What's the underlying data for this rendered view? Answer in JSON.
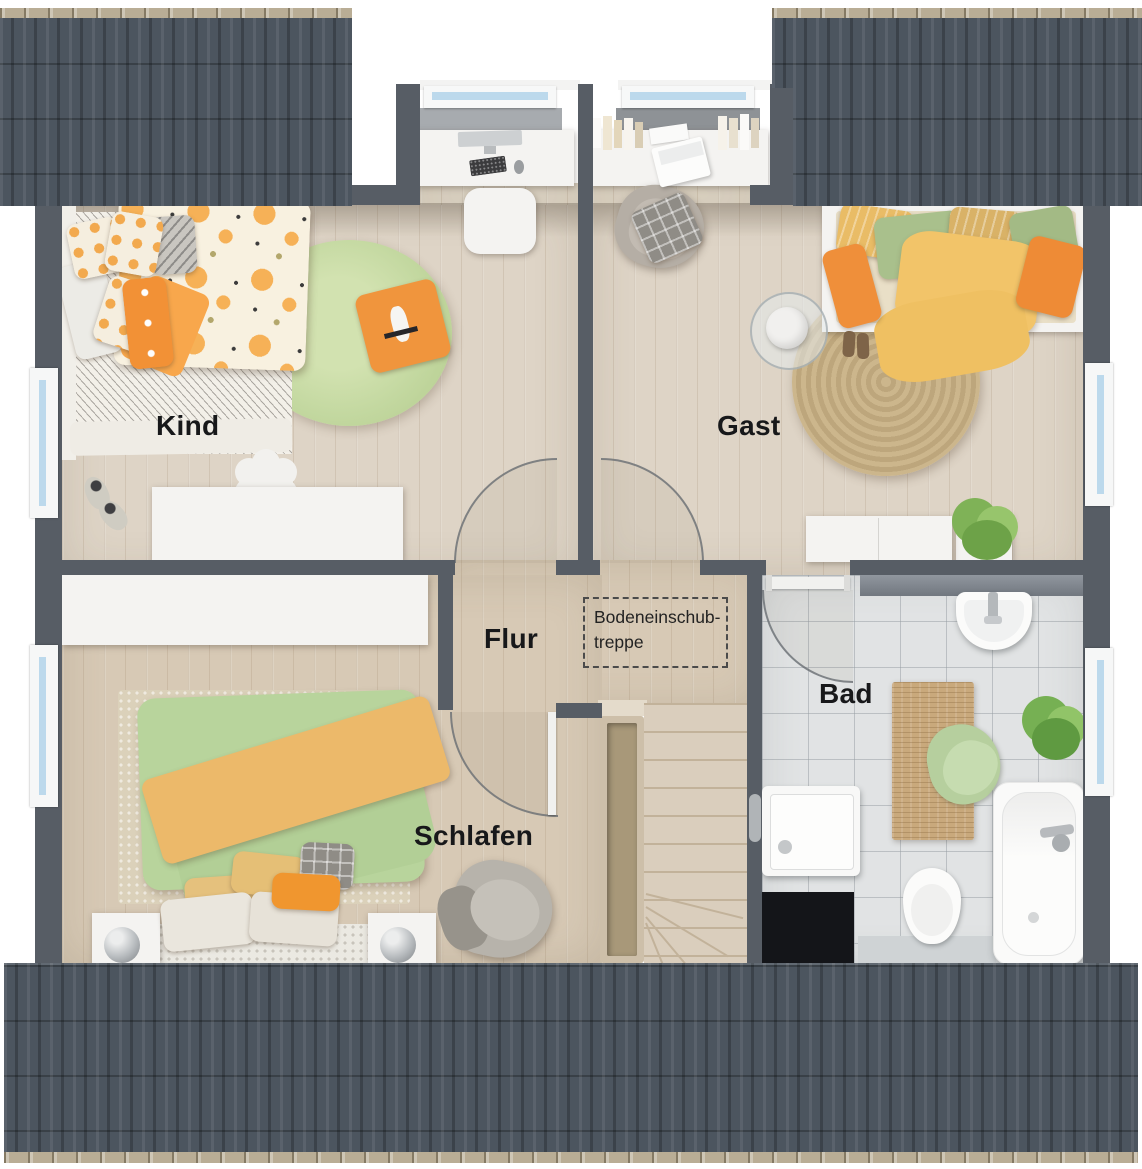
{
  "rooms": {
    "kind": {
      "label": "Kind"
    },
    "gast": {
      "label": "Gast"
    },
    "flur": {
      "label": "Flur"
    },
    "schlafen": {
      "label": "Schlafen"
    },
    "bad": {
      "label": "Bad"
    }
  },
  "annotations": {
    "attic": {
      "line1": "Bodeneinschub-",
      "line2": "treppe"
    }
  },
  "colors": {
    "roof": "#4c555f",
    "wall": "#575d65",
    "wood_floor": "#ded4c6",
    "wood_floor_warm": "#d7c9b5",
    "bath_tile": "#e1e3e4",
    "window_glass": "#bcd9ec",
    "accent_orange": "#ef8f3a",
    "accent_green": "#aec68f",
    "accent_yellow": "#f2c469",
    "rug_green": "#c3d8a0",
    "rug_jute": "#c4ae84"
  }
}
